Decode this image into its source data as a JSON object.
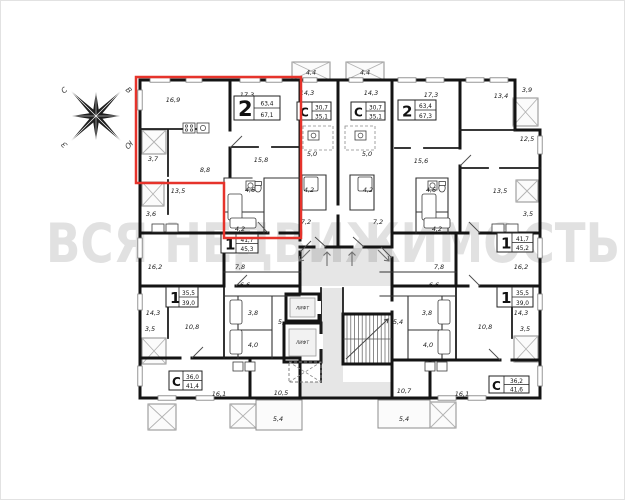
{
  "watermark": "ВСЯ НЕДВИЖИМОСТЬ",
  "compass": {
    "north": "С",
    "east": "В",
    "south": "Ю",
    "west": "З"
  },
  "core": {
    "elevator": "ЛИФТ"
  },
  "highlight_color": "#e6332b",
  "apartments": [
    {
      "name": "apt-2room-left",
      "type": "2",
      "living": "63,4",
      "total": "67,1",
      "highlighted": true
    },
    {
      "name": "studio-top-left",
      "type": "С",
      "living": "30,7",
      "total": "35,1"
    },
    {
      "name": "studio-top-right",
      "type": "С",
      "living": "30,7",
      "total": "35,1"
    },
    {
      "name": "apt-2room-right",
      "type": "2",
      "living": "63,4",
      "total": "67,3"
    },
    {
      "name": "apt-1room-mid-left",
      "type": "1",
      "living": "41,7",
      "total": "45,3"
    },
    {
      "name": "apt-1room-mid-right",
      "type": "1",
      "living": "41,7",
      "total": "45,2"
    },
    {
      "name": "apt-1room-lower-left",
      "type": "1",
      "living": "35,5",
      "total": "39,0"
    },
    {
      "name": "apt-1room-lower-right",
      "type": "1",
      "living": "35,5",
      "total": "39,0"
    },
    {
      "name": "studio-bottom-left",
      "type": "С",
      "living": "36,0",
      "total": "41,4"
    },
    {
      "name": "studio-bottom-right",
      "type": "С",
      "living": "36,2",
      "total": "41,6"
    }
  ],
  "rooms": [
    "16,9",
    "17,3",
    "3,7",
    "8,8",
    "15,8",
    "4,6",
    "4,2",
    "4,4",
    "14,3",
    "5,0",
    "4,2",
    "7,2",
    "4,4",
    "14,3",
    "5,0",
    "4,2",
    "7,2",
    "17,3",
    "15,6",
    "4,6",
    "4,2",
    "13,4",
    "3,9",
    "12,5",
    "13,5",
    "3,5",
    "13,5",
    "3,6",
    "16,2",
    "7,8",
    "7,8",
    "16,2",
    "14,3",
    "3,5",
    "10,8",
    "6,6",
    "3,8",
    "4,0",
    "5,4",
    "6,6",
    "3,8",
    "4,0",
    "5,4",
    "10,8",
    "14,3",
    "3,5",
    "16,1",
    "10,5",
    "5,4",
    "10,7",
    "16,1",
    "5,4"
  ]
}
